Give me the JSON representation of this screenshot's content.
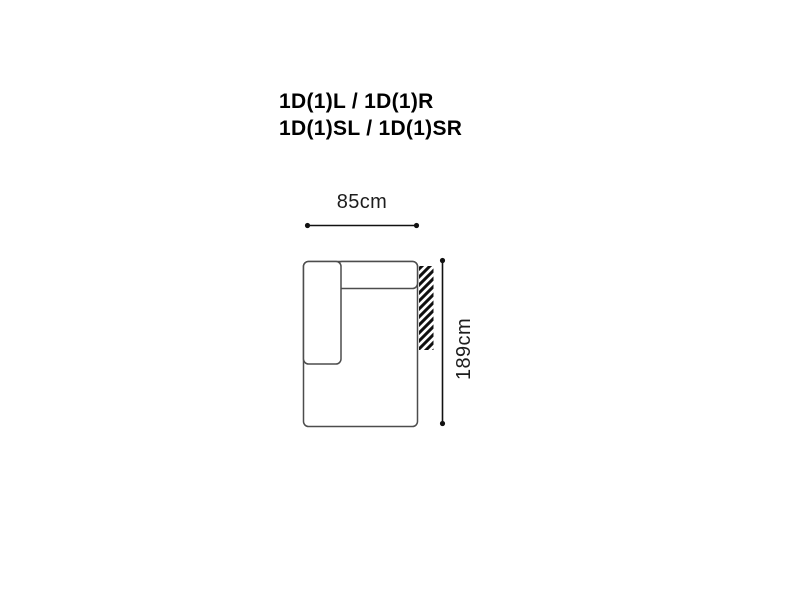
{
  "title": {
    "line1": "1D(1)L / 1D(1)R",
    "line2": "1D(1)SL / 1D(1)SR"
  },
  "diagram": {
    "type": "furniture-module-top-view",
    "width_label": "85cm",
    "height_label": "189cm",
    "icons": {
      "hatch_icon": "diagonal-stripe-hatching-connection-side",
      "dimension_endpoint": "round-dot"
    },
    "colors": {
      "background": "#ffffff",
      "title_text": "#000000",
      "label_text": "#1d1d1d",
      "sofa_outline": "#4d4d4d",
      "dimension_line": "#111111",
      "hatch": "#111111"
    }
  }
}
